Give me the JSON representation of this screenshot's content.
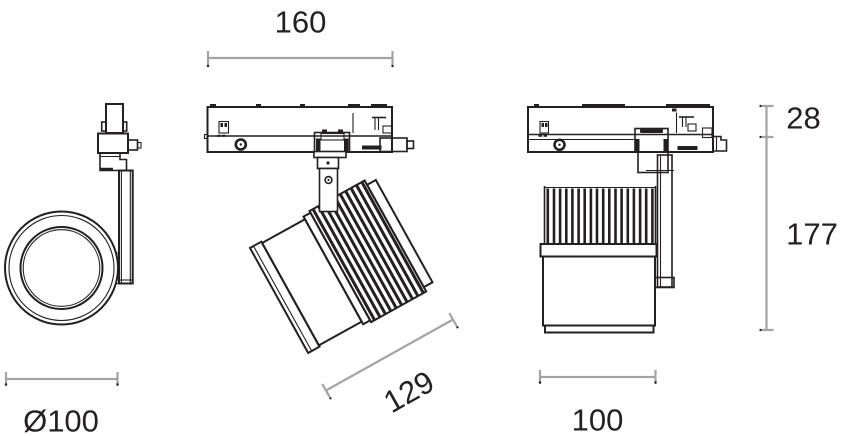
{
  "dimensions": {
    "left_diameter": "Ø100",
    "front_track_width": "160",
    "front_body_length": "129",
    "right_adapter_height": "28",
    "right_body_height": "177",
    "right_body_width": "100"
  },
  "colors": {
    "line": "#241f20",
    "dimension_line": "#a3a3a5",
    "background": "#ffffff"
  }
}
